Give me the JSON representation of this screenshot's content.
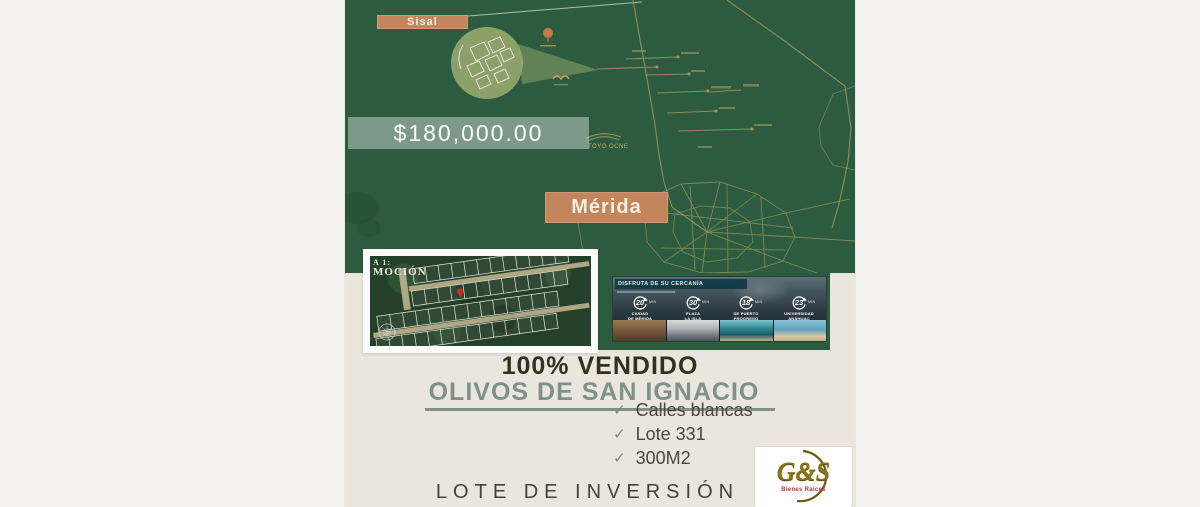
{
  "map": {
    "sisal_label": "Sisal",
    "merida_label": "Mérida",
    "price": "$180,000.00",
    "landmark_label": "TOYO OCNE"
  },
  "inset": {
    "caption_line1": "A 1:",
    "caption_line2": "MOCIÓN"
  },
  "proximity": {
    "title": "DISFRUTA DE SU CERCANÍA",
    "items": [
      {
        "value": "20",
        "unit": "MIN",
        "label1": "CIUDAD",
        "label2": "DE MÉRIDA"
      },
      {
        "value": "30",
        "unit": "MIN",
        "label1": "PLAZA",
        "label2": "LA ISLA"
      },
      {
        "value": "18",
        "unit": "MIN",
        "label1": "DE PUERTO",
        "label2": "PROGRESO"
      },
      {
        "value": "23",
        "unit": "MIN",
        "label1": "UNIVERSIDAD",
        "label2": "ANÁHUAC"
      }
    ]
  },
  "details": {
    "sold_banner": "100% VENDIDO",
    "project_name": "OLIVOS DE SAN IGNACIO",
    "features": [
      "Calles blancas",
      "Lote 331",
      "300M2"
    ],
    "footer": "LOTE DE INVERSIÓN"
  },
  "brand": {
    "name": "G&S",
    "tagline": "Bienes Raíces"
  },
  "colors": {
    "map_green": "#2d5b3f",
    "accent_tan": "#c3865c",
    "sage": "#7e9285",
    "beige": "#eae6de",
    "logo_gold": "#8a7516",
    "tagline_red": "#b5352b"
  }
}
